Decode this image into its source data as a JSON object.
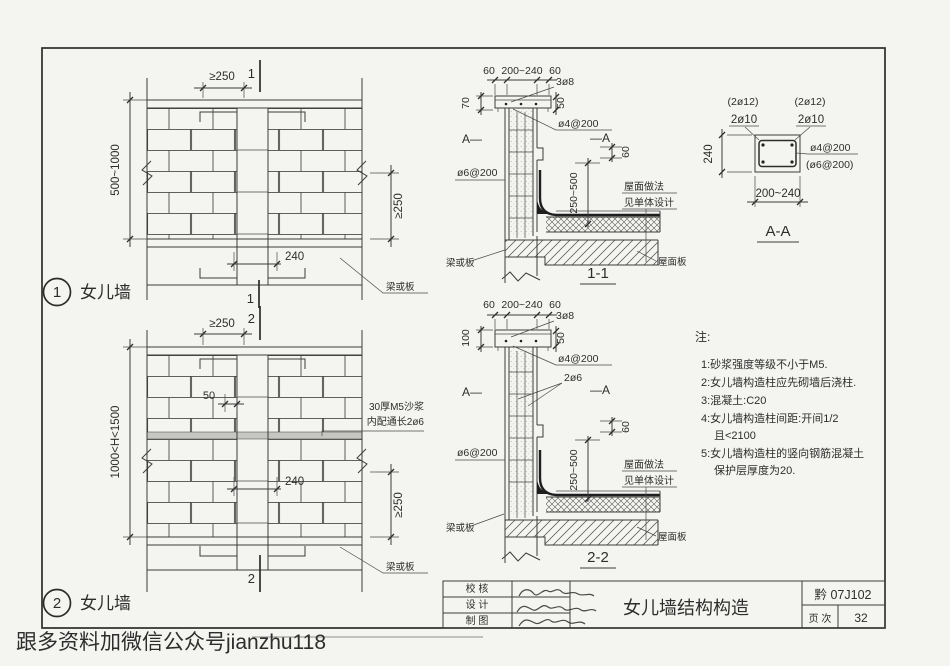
{
  "watermark": {
    "text": "跟多资料加微信公众号jianzhu118",
    "color": "#c43a25"
  },
  "detail1": {
    "index": "1",
    "title": "女儿墙",
    "dim_top": "≥250",
    "cut_top": "1",
    "cut_bottom": "1",
    "dim_height": "500~1000",
    "dim_right": "≥250",
    "dim_width": "240",
    "leader_beam": "梁或板"
  },
  "detail2": {
    "index": "2",
    "title": "女儿墙",
    "dim_top": "≥250",
    "cut_top": "2",
    "cut_bottom": "2",
    "dim_height": "1000<H<1500",
    "dim_offset": "50",
    "dim_width": "240",
    "dim_right": "≥250",
    "mortar_note_1": "30厚M5沙浆",
    "mortar_note_2": "内配通长2ø6",
    "leader_beam": "梁或板"
  },
  "section11": {
    "title": "1-1",
    "dim_60_left": "60",
    "dim_mid": "200~240",
    "dim_60_right": "60",
    "rebar_top": "3ø8",
    "coping_height": "70",
    "coping_edge": "50",
    "rebar_coping": "ø4@200",
    "cut_left": "A—",
    "cut_right": "—A",
    "rebar_wall": "ø6@200",
    "dim_upstand": "60",
    "dim_range": "250~500",
    "roof_note_1": "屋面做法",
    "roof_note_2": "见单体设计",
    "leader_beam": "梁或板",
    "leader_roof": "屋面板"
  },
  "section22": {
    "title": "2-2",
    "dim_60_left": "60",
    "dim_mid": "200~240",
    "dim_60_right": "60",
    "rebar_top": "3ø8",
    "coping_height": "100",
    "coping_edge": "50",
    "rebar_coping": "ø4@200",
    "rebar_vertical": "2ø6",
    "cut_left": "A—",
    "cut_right": "—A",
    "rebar_wall": "ø6@200",
    "dim_upstand": "60",
    "dim_range": "250~500",
    "roof_note_1": "屋面做法",
    "roof_note_2": "见单体设计",
    "leader_beam": "梁或板",
    "leader_roof": "屋面板"
  },
  "sectionAA": {
    "title": "A-A",
    "bars_opt_left": "(2ø12)",
    "bars_left": "2ø10",
    "bars_opt_right": "(2ø12)",
    "bars_right": "2ø10",
    "dim_height": "240",
    "tie": "ø4@200",
    "tie_opt": "(ø6@200)",
    "dim_width": "200~240"
  },
  "notes": {
    "heading": "注:",
    "lines": [
      "1:砂浆强度等级不小于M5.",
      "2:女儿墙构造柱应先砌墙后浇柱.",
      "3:混凝土:C20",
      "4:女儿墙构造柱间距:开间1/2",
      "且<2100",
      "5:女儿墙构造柱的竖向钢筋混凝土",
      "保护层厚度为20."
    ]
  },
  "titleblock": {
    "check_label": "校 核",
    "design_label": "设 计",
    "draft_label": "制 图",
    "drawing_title": "女儿墙结构构造",
    "atlas_no": "黔 07J102",
    "page_label": "页 次",
    "page_no": "32"
  }
}
